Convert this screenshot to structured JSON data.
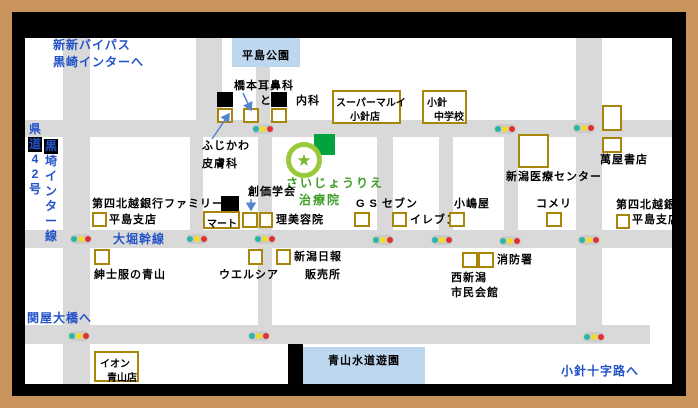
{
  "colors": {
    "frame_tan": "#c9955c",
    "road_gray": "#d9d9d9",
    "park_blue": "#bdd7ee",
    "gold_box_border": "#a8860c",
    "blue_text": "#2353c8",
    "green_text": "#3f9e28",
    "logo_square_green": "#00a33e",
    "logo_ring_green": "#9aca3c",
    "logo_star_green": "#7ab82e",
    "arrow_blue": "#5585d0",
    "light_teal": "#2ab5a5",
    "light_yellow": "#f0dc28",
    "light_red": "#e03030"
  },
  "directions": {
    "top_left_line1": "新新バイパス",
    "top_left_line2": "黒崎インターへ",
    "bottom_left": "関屋大橋へ",
    "bottom_right": "小針十字路へ"
  },
  "route_sign": {
    "left_column": "県道42号",
    "right_column": "黒埼インター線",
    "highlight_chars": "道黒"
  },
  "roads": {
    "ohori_label": "大堀幹線"
  },
  "parks": {
    "hirashima": "平島公園",
    "aoyama_suido": "青山水道遊園"
  },
  "clinic": {
    "line1": "さいじょうりえ",
    "line2": "治療院"
  },
  "places": {
    "hashimoto_ent": "橋本耳鼻科",
    "to_fragment": "と",
    "naika": "内科",
    "super_marui": "スーパーマルイ",
    "kobari_branch": "小針店",
    "kobari": "小針",
    "junior_high": "中学校",
    "fujikawa": "ふじかわ",
    "dermatology": "皮膚科",
    "soka_gakkai": "創価学会",
    "niigata_medical_center": "新潟医療センター",
    "yorozuya_books": "萬屋書店",
    "daishi_hokuetsu_bank": "第四北越銀行",
    "hirashima_branch": "平島支店",
    "family": "ファミリー",
    "mart": "マート",
    "hair_salon": "理美容院",
    "gs": "GS",
    "seven": "セブン",
    "eleven": "イレブン",
    "kojimaya": "小嶋屋",
    "komeri": "コメリ",
    "aoyama_suits": "紳士服の青山",
    "welcia": "ウエルシア",
    "niigata_nippo": "新潟日報",
    "sales_office": "販売所",
    "fire_station": "消防署",
    "nishi_niigata": "西新潟",
    "civic_hall": "市民会館",
    "aeon": "イオン",
    "aoyama_store": "青山店"
  }
}
